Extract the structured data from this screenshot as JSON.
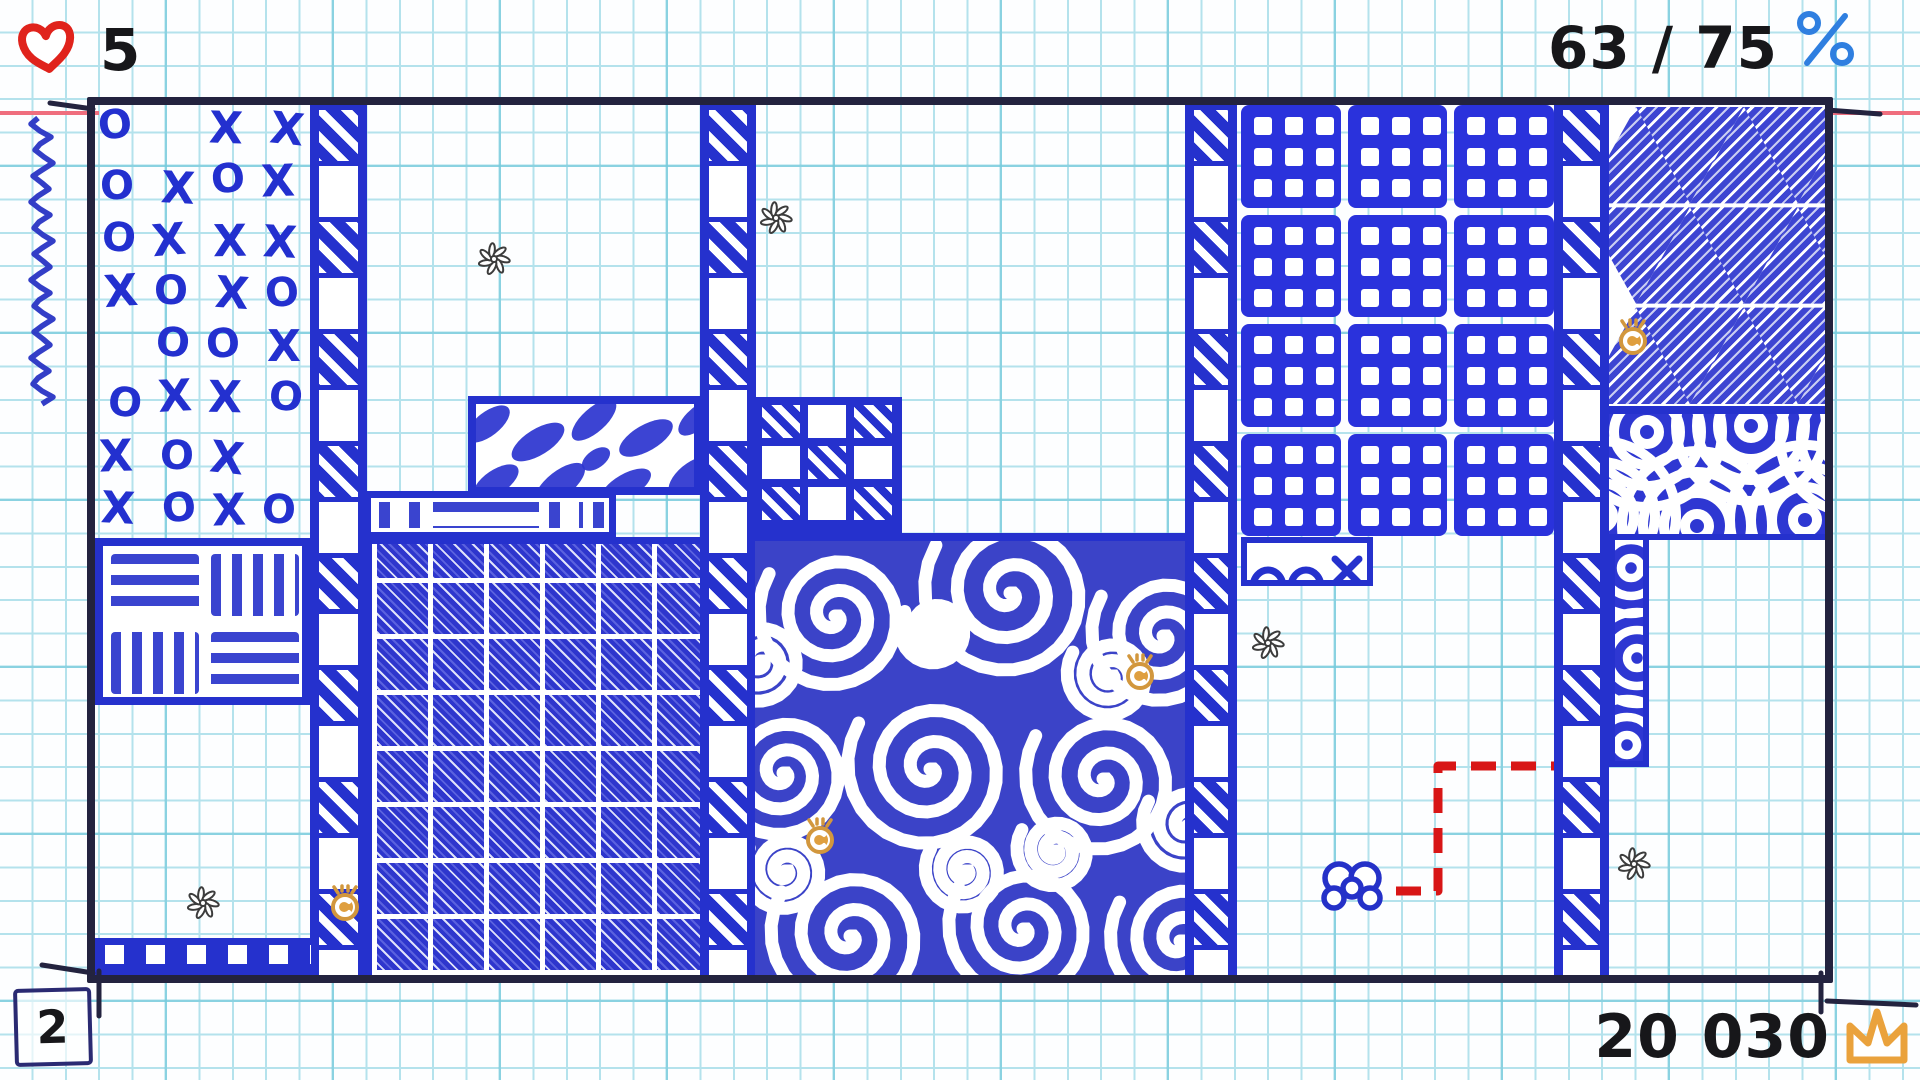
{
  "hud": {
    "lives": {
      "icon": "heart-icon",
      "label": "5"
    },
    "progress": {
      "label": "63 / 75",
      "icon": "percent-icon"
    },
    "level": {
      "label": "2"
    },
    "score": {
      "label": "20 030",
      "icon": "crown-icon"
    }
  },
  "colors": {
    "pen": "#2531cd",
    "spiral_bg": "#3b43c8",
    "waffle": "#2a32dc",
    "grid": "#b4e2ec",
    "margin_line": "#ef6e7e",
    "field_border": "#23233f",
    "heart_red": "#e0231c",
    "percent_blue": "#2f7fe0",
    "gold": "#eaa23c",
    "trail_red": "#d81616",
    "text": "#17171a",
    "flower_gray": "#3c3c3c"
  },
  "board": {
    "xo_rows": [
      "O.XX",
      "OXOX",
      "OXXX",
      "XOXO",
      ".OOX",
      "OXXO",
      "XOX.",
      "XOXO"
    ],
    "regions": [
      {
        "name": "xo-doodles",
        "type": "xo",
        "x": 97,
        "y": 107,
        "w": 213,
        "h": 431
      },
      {
        "name": "ladder-strip-left",
        "type": "ladder",
        "x": 310,
        "y": 105,
        "w": 57,
        "h": 870
      },
      {
        "name": "basket-weave",
        "type": "basket",
        "x": 95,
        "y": 538,
        "w": 215,
        "h": 167
      },
      {
        "name": "film-strip-bar",
        "type": "film",
        "x": 95,
        "y": 938,
        "w": 216,
        "h": 37
      },
      {
        "name": "cow-spots",
        "type": "cow",
        "x": 468,
        "y": 396,
        "w": 234,
        "h": 99
      },
      {
        "name": "scribble-bars",
        "type": "bars",
        "x": 364,
        "y": 491,
        "w": 252,
        "h": 48
      },
      {
        "name": "crosshatch-grid",
        "type": "hatch",
        "x": 365,
        "y": 537,
        "w": 337,
        "h": 438
      },
      {
        "name": "ladder-strip-center",
        "type": "ladder",
        "x": 700,
        "y": 105,
        "w": 56,
        "h": 870
      },
      {
        "name": "window-pane",
        "type": "pane",
        "x": 754,
        "y": 397,
        "w": 148,
        "h": 138
      },
      {
        "name": "spiral-field",
        "type": "spiral",
        "x": 755,
        "y": 533,
        "w": 430,
        "h": 442
      },
      {
        "name": "ladder-strip-right-inner",
        "type": "ladder",
        "x": 1185,
        "y": 105,
        "w": 52,
        "h": 870
      },
      {
        "name": "waffle-plaid",
        "type": "plaid",
        "x": 1241,
        "y": 105,
        "w": 313,
        "h": 431,
        "cols": 3,
        "rows": 4
      },
      {
        "name": "arc-doodle-strip",
        "type": "arcs",
        "x": 1241,
        "y": 537,
        "w": 132,
        "h": 49
      },
      {
        "name": "ladder-strip-right-outer",
        "type": "ladder",
        "x": 1554,
        "y": 105,
        "w": 55,
        "h": 870
      },
      {
        "name": "triangle-hatch",
        "type": "tri",
        "x": 1609,
        "y": 105,
        "w": 216,
        "h": 309
      },
      {
        "name": "rings-block",
        "type": "rings",
        "x": 1609,
        "y": 414,
        "w": 216,
        "h": 126,
        "cols": 3,
        "rows": 2
      },
      {
        "name": "rings-column",
        "type": "rings",
        "x": 1609,
        "y": 540,
        "w": 40,
        "h": 227,
        "cols": 1,
        "rows": 3
      }
    ],
    "entities": {
      "player": {
        "name": "butterfly",
        "x": 1352,
        "y": 886
      },
      "trail": {
        "points": [
          [
            1396,
            891
          ],
          [
            1438,
            891
          ],
          [
            1438,
            766
          ],
          [
            1554,
            766
          ]
        ]
      },
      "bonuses": [
        {
          "x": 345,
          "y": 903
        },
        {
          "x": 820,
          "y": 836
        },
        {
          "x": 1140,
          "y": 672
        },
        {
          "x": 1633,
          "y": 337
        }
      ],
      "flowers": [
        {
          "x": 494,
          "y": 259
        },
        {
          "x": 776,
          "y": 218
        },
        {
          "x": 1268,
          "y": 643
        },
        {
          "x": 203,
          "y": 903
        },
        {
          "x": 1634,
          "y": 864
        }
      ]
    }
  }
}
